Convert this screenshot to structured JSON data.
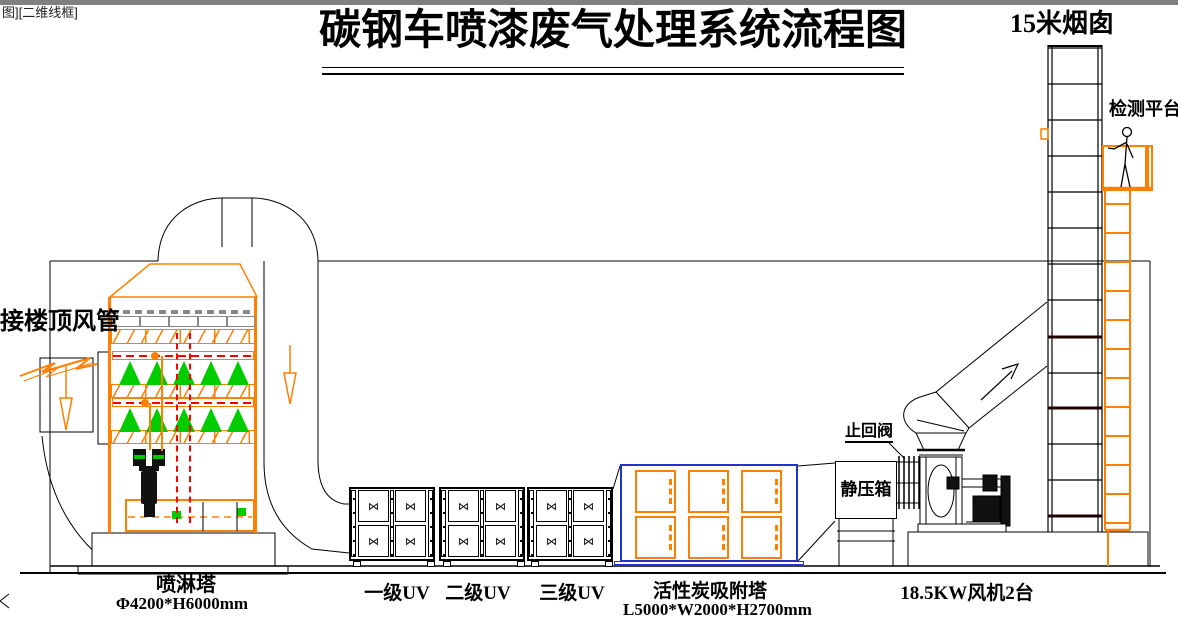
{
  "meta": {
    "viewport_label": "图][二维线框]"
  },
  "title": {
    "text": "碳钢车喷漆废气处理系统流程图"
  },
  "labels": {
    "chimney": "15米烟囱",
    "platform": "检测平台",
    "roof_duct": "接楼顶风管",
    "spray_tower_name": "喷淋塔",
    "spray_tower_dims": "Φ4200*H6000mm",
    "uv1": "一级UV",
    "uv2": "二级UV",
    "uv3": "三级UV",
    "carbon_name": "活性炭吸附塔",
    "carbon_dims": "L5000*W2000*H2700mm",
    "static_box": "静压箱",
    "check_valve": "止回阀",
    "fan": "18.5KW风机2台"
  },
  "glyphs": {
    "door_handle": "⋈"
  },
  "colors": {
    "accent_orange": "#ff8000",
    "spray_green": "#00cc00",
    "pipe_red": "#ff0000",
    "carbon_blue": "#2233cc",
    "packing_grey": "#888888",
    "edge_grey": "#808080"
  }
}
